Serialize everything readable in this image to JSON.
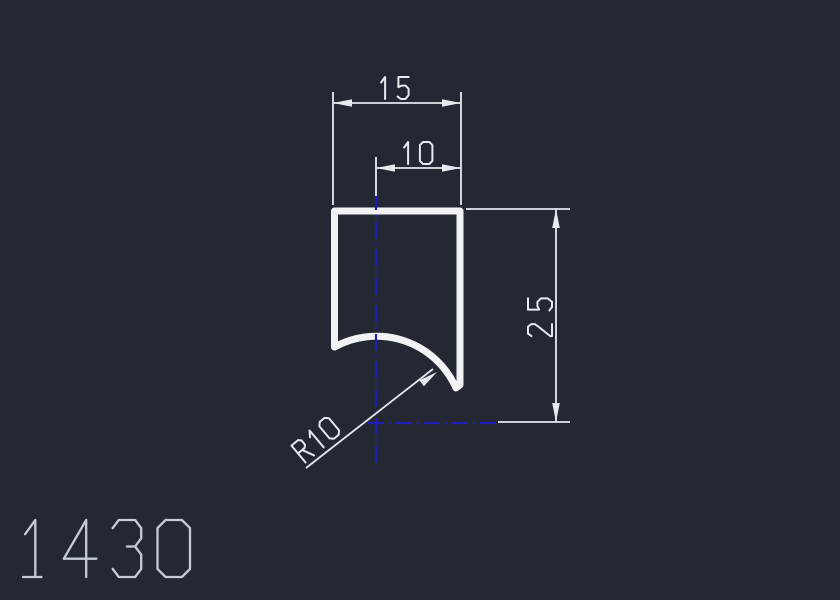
{
  "drawing": {
    "part_number": "1430",
    "dimensions": {
      "width_top": {
        "label": "15"
      },
      "width_inner": {
        "label": "10"
      },
      "height_right": {
        "label": "25"
      },
      "radius": {
        "label": "R10"
      }
    },
    "colors": {
      "background": "#232833",
      "outline": "#f0f2f5",
      "dim": "#e6e9ee",
      "part_text": "#c6ccd5",
      "centerline": "#1e1eb4"
    }
  }
}
